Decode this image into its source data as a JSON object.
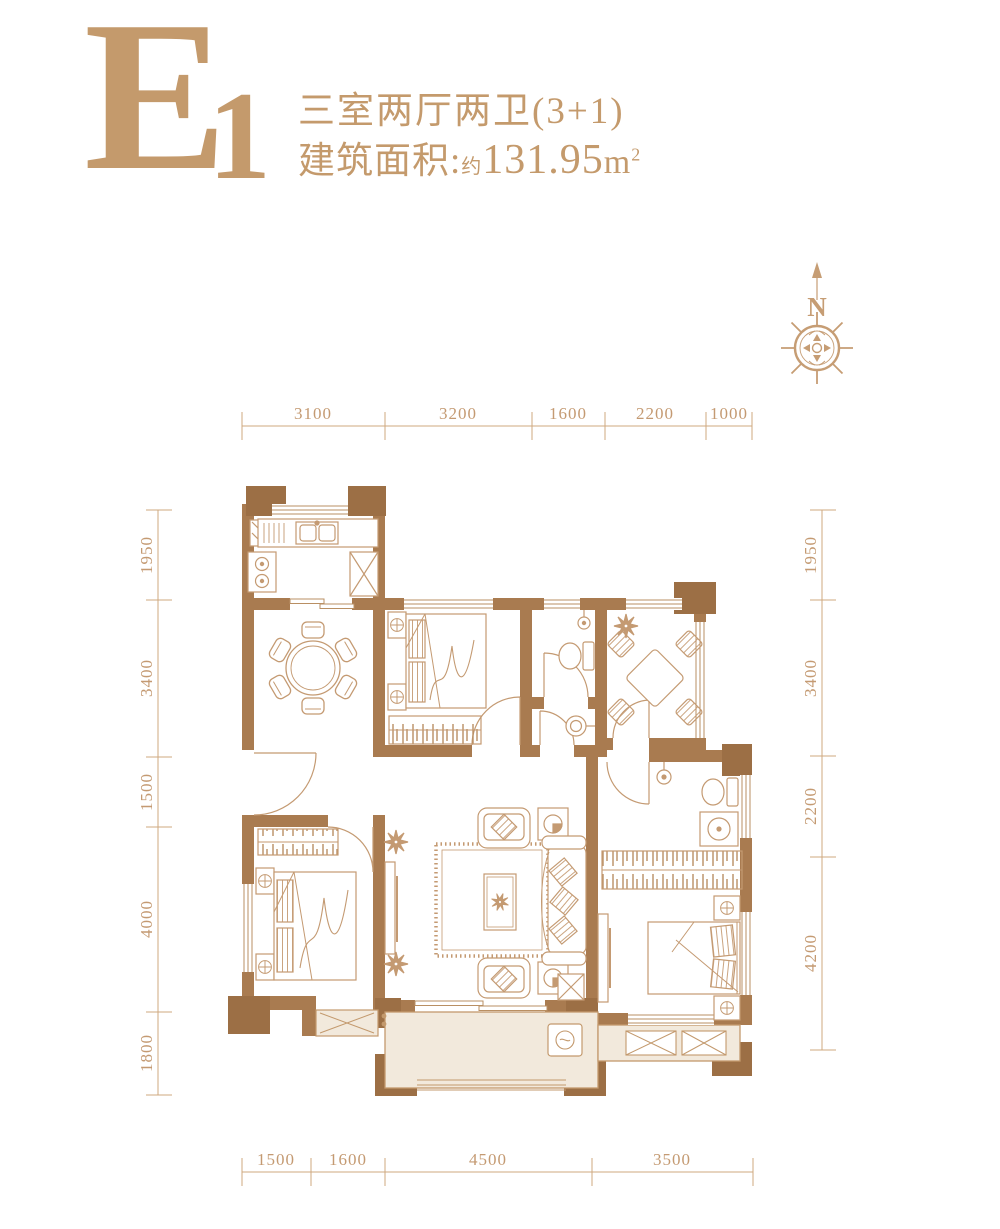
{
  "header": {
    "plan_code_main": "E",
    "plan_code_sub": "1",
    "layout_text": "三室两厅两卫(3+1)",
    "area_label": "建筑面积:",
    "area_approx": "约",
    "area_value": "131.95",
    "area_unit_base": "m",
    "area_unit_exp": "2"
  },
  "compass": {
    "north_label": "N"
  },
  "dims": {
    "top": [
      "3100",
      "3200",
      "1600",
      "2200",
      "1000"
    ],
    "bottom": [
      "1500",
      "1600",
      "4500",
      "3500"
    ],
    "left": [
      "1950",
      "3400",
      "1500",
      "4000",
      "1800"
    ],
    "right": [
      "1950",
      "3400",
      "2200",
      "4200"
    ]
  },
  "colors": {
    "accent": "#c49a6c",
    "wall": "#a97b50",
    "pillar": "#9c6f45",
    "furniture_line": "#c49a72",
    "dimension_line": "#cfa87f",
    "balcony_fill": "#f2e9dc",
    "background": "#ffffff"
  }
}
